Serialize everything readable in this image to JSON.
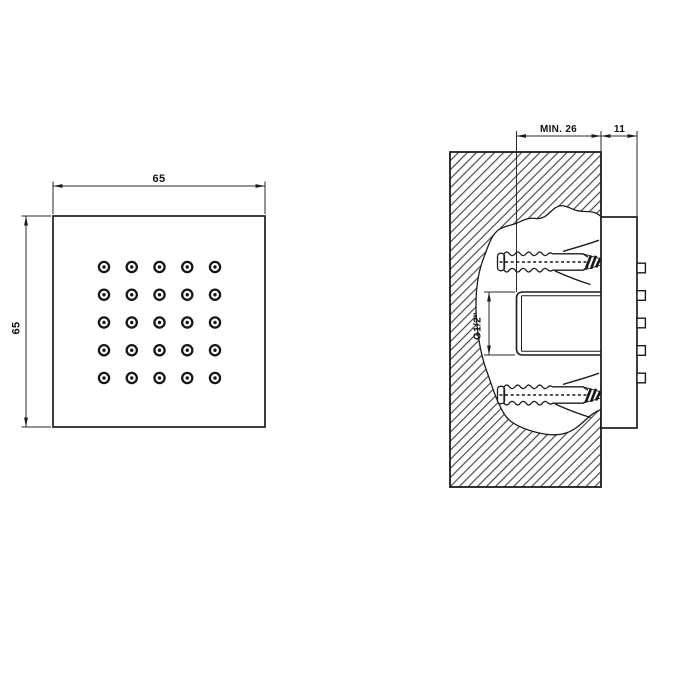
{
  "front_view": {
    "dim_width_label": "65",
    "dim_height_label": "65",
    "nozzle_grid": {
      "rows": 5,
      "cols": 5
    }
  },
  "section_view": {
    "dim_min_depth_label": "MIN. 26",
    "dim_protrusion_label": "11",
    "thread_size_label": "G1/2\"",
    "nozzle_bumps": 5,
    "wall_anchors": 2
  },
  "colors": {
    "line": "#1c1c1c",
    "background": "#ffffff"
  }
}
